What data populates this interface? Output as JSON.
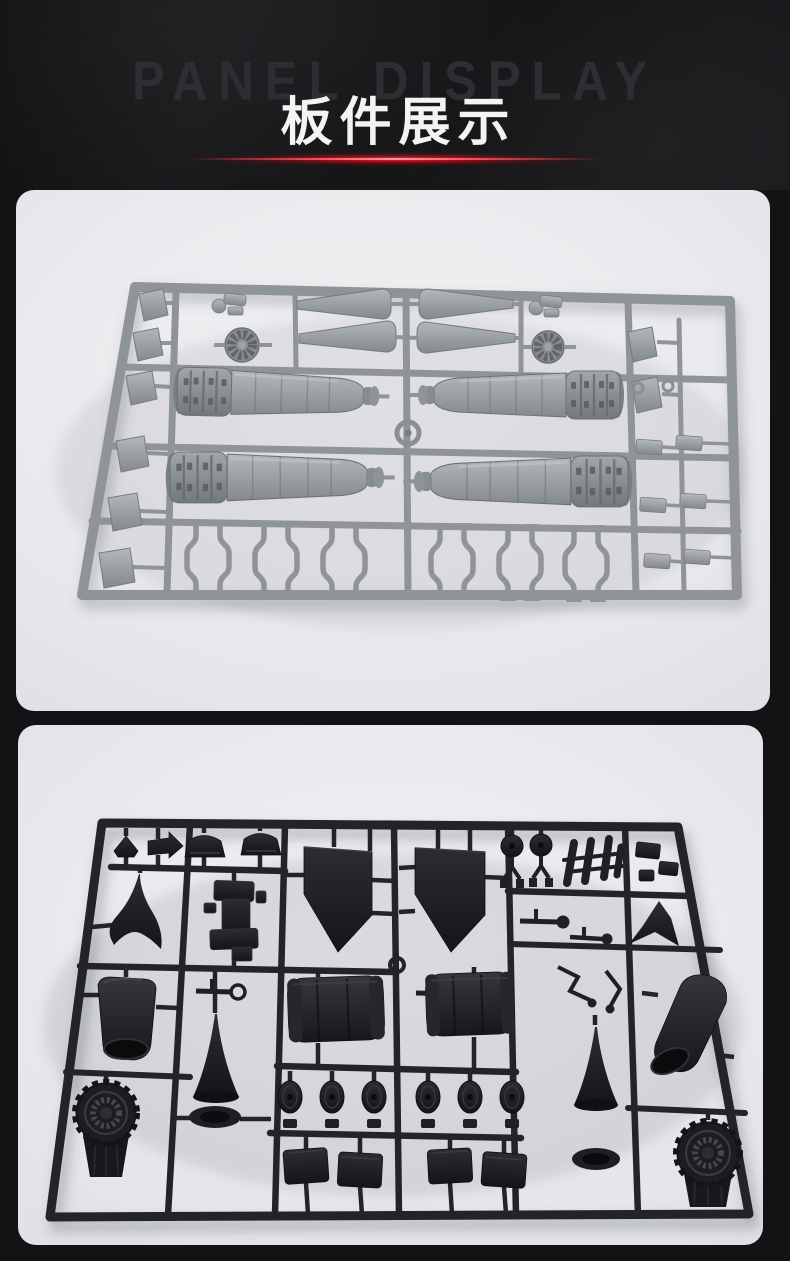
{
  "page": {
    "background_color": "#131316"
  },
  "header": {
    "watermark_text": "PANEL DISPLAY",
    "title_text": "板件展示",
    "title_color": "#f2f3f5",
    "watermark_color": "#2e2e32",
    "background_color": "#1a1a1d",
    "accent_glow_color": "#e01321"
  },
  "photos": [
    {
      "caption": "Light grey injection-molded sprue with four ribbed engine nacelle halves, exhaust cones, two turbine fan faces, stabilizer fins along the edges and rows of landing-gear struts",
      "plastic_color": "#94999b",
      "backdrop_color": "#ebecee"
    },
    {
      "caption": "Black injection-molded sprue with two wing panels, two swept vertical fins, intake ducts, nose cones, two turbine wheels, six small wheels, hatch panels and undercarriage parts",
      "plastic_color": "#202226",
      "backdrop_color": "#e9eaec"
    }
  ]
}
